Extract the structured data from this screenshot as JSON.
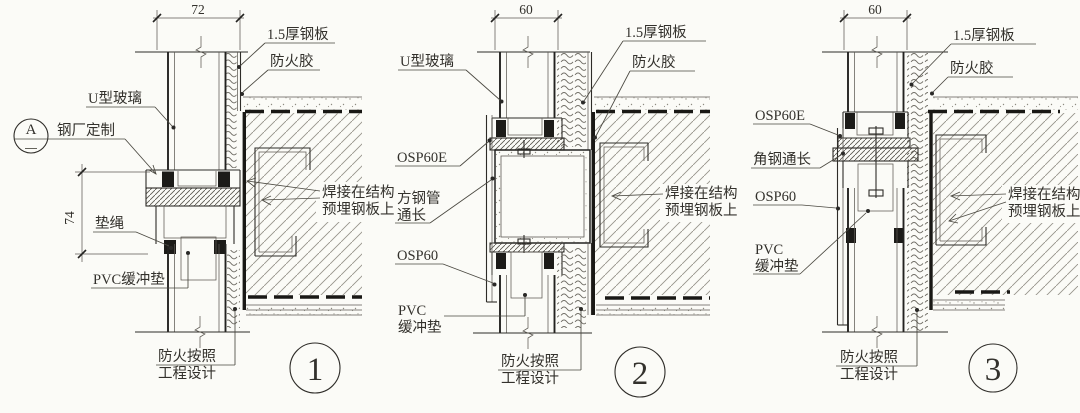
{
  "colors": {
    "paper": "#fbfbf7",
    "ink": "#2e2c28"
  },
  "details": [
    {
      "bubble_number": "1",
      "dim_top": "72",
      "dim_side": "74",
      "marker_letter": "A",
      "labels": {
        "steel_plate": "1.5厚钢板",
        "fire_glue": "防火胶",
        "u_glass": "U型玻璃",
        "factory_custom": "钢厂定制",
        "cushion_rope": "垫绳",
        "pvc_pad": "PVC缓冲垫",
        "weld_line1": "焊接在结构",
        "weld_line2": "预埋钢板上",
        "fire_line1": "防火按照",
        "fire_line2": "工程设计"
      }
    },
    {
      "bubble_number": "2",
      "dim_top": "60",
      "labels": {
        "u_glass": "U型玻璃",
        "steel_plate": "1.5厚钢板",
        "fire_glue": "防火胶",
        "osp_top": "OSP60E",
        "square_tube_line1": "方钢管",
        "square_tube_line2": "通长",
        "osp_bottom": "OSP60",
        "pvc_line1": "PVC",
        "pvc_line2": "缓冲垫",
        "weld_line1": "焊接在结构",
        "weld_line2": "预埋钢板上",
        "fire_line1": "防火按照",
        "fire_line2": "工程设计"
      }
    },
    {
      "bubble_number": "3",
      "dim_top": "60",
      "labels": {
        "steel_plate": "1.5厚钢板",
        "fire_glue": "防火胶",
        "osp_top": "OSP60E",
        "angle_steel": "角钢通长",
        "osp_bottom": "OSP60",
        "pvc_line1": "PVC",
        "pvc_line2": "缓冲垫",
        "weld_line1": "焊接在结构",
        "weld_line2": "预埋钢板上",
        "fire_line1": "防火按照",
        "fire_line2": "工程设计"
      }
    }
  ]
}
